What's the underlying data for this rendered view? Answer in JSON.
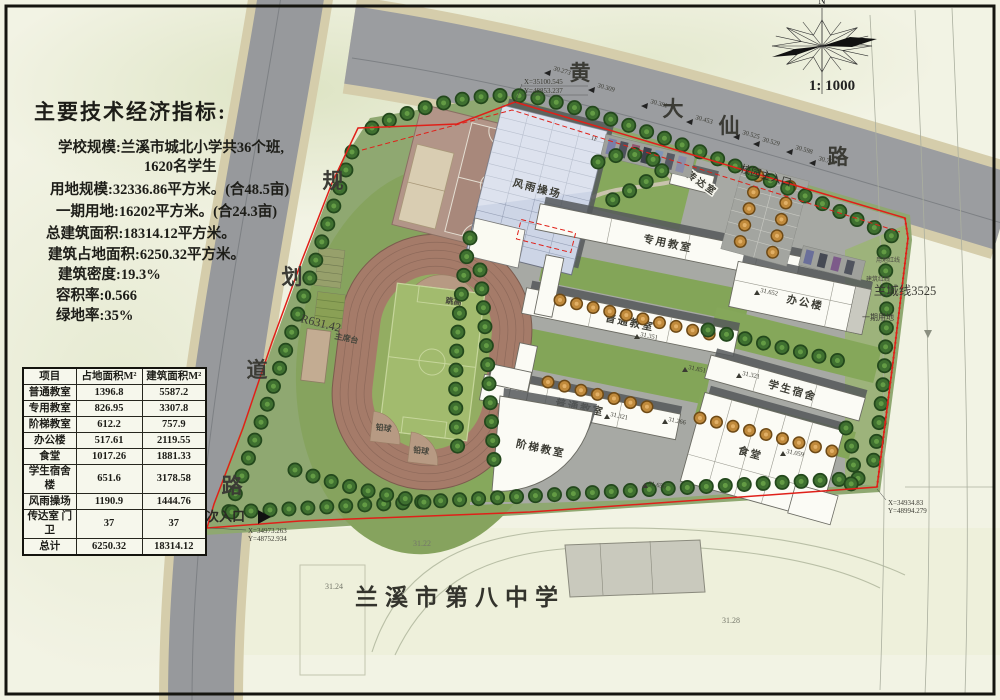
{
  "indicators": {
    "title": "主要技术经济指标:",
    "lines": [
      "学校规模:兰溪市城北小学共36个班,",
      "1620名学生",
      "用地规模:32336.86平方米。(合48.5亩)",
      "一期用地:16202平方米。(合24.3亩)",
      "总建筑面积:18314.12平方米。",
      "建筑占地面积:6250.32平方米。",
      "建筑密度:19.3%",
      "容积率:0.566",
      "绿地率:35%"
    ]
  },
  "area_table": {
    "headers": [
      "项目",
      "占地面积M²",
      "建筑面积M²"
    ],
    "rows": [
      [
        "普通教室",
        "1396.8",
        "5587.2"
      ],
      [
        "专用教室",
        "826.95",
        "3307.8"
      ],
      [
        "阶梯教室",
        "612.2",
        "757.9"
      ],
      [
        "办公楼",
        "517.61",
        "2119.55"
      ],
      [
        "食堂",
        "1017.26",
        "1881.33"
      ],
      [
        "学生宿舍楼",
        "651.6",
        "3178.58"
      ],
      [
        "风雨操场",
        "1190.9",
        "1444.76"
      ],
      [
        "传达室 门卫",
        "37",
        "37"
      ],
      [
        "总计",
        "6250.32",
        "18314.12"
      ]
    ]
  },
  "compass": {
    "north": "N",
    "scale": "1: 1000"
  },
  "roads": {
    "huangdaxian": [
      "黄",
      "大",
      "仙",
      "路"
    ],
    "guihua": [
      "规",
      "划",
      "道",
      "路"
    ],
    "radius": "R631.42"
  },
  "site_labels": {
    "fengyu": "风雨操场",
    "zhuanyong": "专用教室",
    "putong1": "普通教室",
    "putong2": "普通教室",
    "jieti": "阶梯教室",
    "bangong": "办公楼",
    "sushe": "学生宿舍",
    "shitang": "食堂",
    "chuandashi": "传达室",
    "tiaogao": "跳高",
    "qianqiu1": "铅球",
    "qianqiu2": "铅球",
    "zhuxitai": "主席台",
    "main_entrance": "校园主入口",
    "secondary_entrance": "次入口",
    "lancheng": "兰城线3525",
    "yongdi_line": "用地红线",
    "jianzhu_line": "建筑红线",
    "yiqi": "一期用地",
    "school8": "兰溪市第八中学",
    "floor1": "1F"
  },
  "coordinates": [
    {
      "x_label": "X=35100.545",
      "y_label": "Y=48853.237"
    },
    {
      "x_label": "X=34934.83",
      "y_label": "Y=48994.279"
    },
    {
      "x_label": "X=34973.263",
      "y_label": "Y=48752.934"
    }
  ],
  "road_elevations": [
    "30.273",
    "30.309",
    "30.381",
    "30.453",
    "30.525",
    "30.529",
    "30.598",
    "30.709"
  ],
  "spot_elevations": [
    "31.351",
    "31.851",
    "31.321",
    "31.266",
    "31.656",
    "31.652",
    "31.321",
    "31.059"
  ],
  "ground_marks": [
    "31.22",
    "31.24",
    "31.28"
  ],
  "titleblock": {
    "company": "浙江·金华市建筑设计院有限公司",
    "company_sub": "设计证号120123-SJ(甲级)   Add:金华市婺州街55号",
    "cols": [
      "项目负责人",
      "专业负责人",
      "设  计",
      "制  图",
      "校  对",
      "审  核",
      "审  定"
    ],
    "tuming_label": "图名",
    "drawing_title": "总平面图",
    "jianshe_label": "建设单位",
    "jianshe_value": "兰溪市云山街道办事处",
    "xiangmu_label": "项目名称",
    "xiangmu_value": "兰溪市城北小学",
    "gongcheng_label": "工程号",
    "gongcheng_value": "2007-2-03",
    "tubie_label": "图  别",
    "tubie_value": "",
    "tuhao_label": "图  号",
    "tuhao_value": "",
    "riqi_label": "日  期",
    "riqi_value": "2007.7",
    "stamp_line1": "未盖出图章",
    "stamp_line2": "本图纸无效"
  },
  "colors": {
    "boundary_red": "#e02019",
    "road_gray": "#9b9da0",
    "lawn_green": "#8fa871",
    "track_brown": "#a57b69",
    "glass_roof": "#cdd5e6",
    "tree_green": "#3f7030"
  }
}
